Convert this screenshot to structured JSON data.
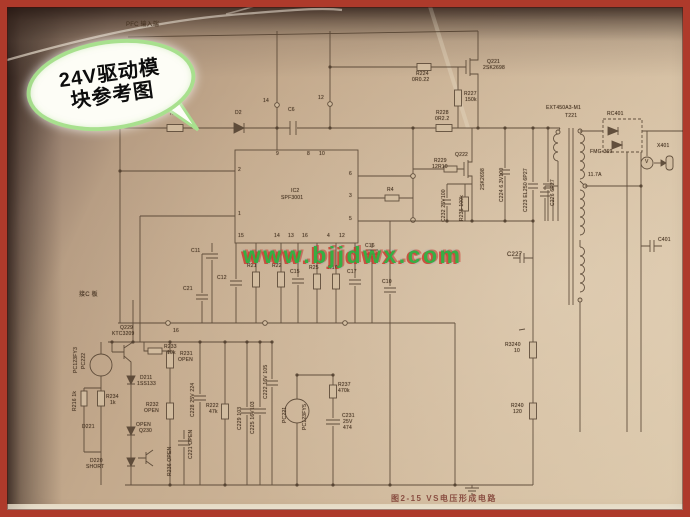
{
  "meta": {
    "figure_caption": "图2-15  VS电压形成电路"
  },
  "callout": {
    "line1": "24V驱动模",
    "line2": "块参考图"
  },
  "watermark": {
    "text": "www.bjjdwx.com"
  },
  "ic": {
    "ref": "IC2",
    "part": "SPF3001"
  },
  "colors": {
    "border": "#ae3a2b",
    "paper": "#ccb497",
    "ink": "#52402f",
    "watermark_green": "#2fae3f",
    "watermark_red": "#cd3728",
    "callout_border": "#a8e08e",
    "caption": "#7d3b31"
  },
  "labels": [
    {
      "t": "PFC 输入端",
      "x": 126,
      "y": 22,
      "s": 6
    },
    {
      "t": "PKG1",
      "x": 80,
      "y": 122,
      "s": 6
    },
    {
      "t": "R1",
      "x": 170,
      "y": 112
    },
    {
      "t": "D2",
      "x": 235,
      "y": 111
    },
    {
      "t": "C6",
      "x": 288,
      "y": 108
    },
    {
      "t": "14",
      "x": 263,
      "y": 99
    },
    {
      "t": "12",
      "x": 318,
      "y": 96
    },
    {
      "t": "R224",
      "x": 416,
      "y": 72
    },
    {
      "t": "0R0.22",
      "x": 412,
      "y": 78
    },
    {
      "t": "Q221",
      "x": 487,
      "y": 60
    },
    {
      "t": "2SK2698",
      "x": 483,
      "y": 66
    },
    {
      "t": "R227",
      "x": 464,
      "y": 92
    },
    {
      "t": "150k",
      "x": 465,
      "y": 98
    },
    {
      "t": "R228",
      "x": 436,
      "y": 111
    },
    {
      "t": "0R2.2",
      "x": 435,
      "y": 117
    },
    {
      "t": "R229",
      "x": 434,
      "y": 159
    },
    {
      "t": "12R10",
      "x": 432,
      "y": 165
    },
    {
      "t": "Q222",
      "x": 455,
      "y": 153
    },
    {
      "t": "2SK2698",
      "x": 481,
      "y": 190,
      "v": 1
    },
    {
      "t": "C232 25V100",
      "x": 442,
      "y": 222,
      "v": 1
    },
    {
      "t": "R235 100k",
      "x": 460,
      "y": 221,
      "v": 1
    },
    {
      "t": "C224 6.3V100",
      "x": 500,
      "y": 202,
      "v": 1
    },
    {
      "t": "C223 EL250 6P27",
      "x": 524,
      "y": 212,
      "v": 1
    },
    {
      "t": "C226 6P27",
      "x": 551,
      "y": 206,
      "v": 1
    },
    {
      "t": "C227",
      "x": 507,
      "y": 252,
      "s": 6
    },
    {
      "t": "EXT450A3-M1",
      "x": 546,
      "y": 106
    },
    {
      "t": "T221",
      "x": 565,
      "y": 114
    },
    {
      "t": "11.7A",
      "x": 588,
      "y": 173
    },
    {
      "t": "RC401",
      "x": 607,
      "y": 112
    },
    {
      "t": "FMG-369",
      "x": 590,
      "y": 150
    },
    {
      "t": "X401",
      "x": 657,
      "y": 144
    },
    {
      "t": "V",
      "x": 645,
      "y": 160
    },
    {
      "t": "C401",
      "x": 658,
      "y": 238
    },
    {
      "t": "R3240",
      "x": 505,
      "y": 343
    },
    {
      "t": "10",
      "x": 514,
      "y": 349
    },
    {
      "t": "R240",
      "x": 511,
      "y": 404
    },
    {
      "t": "120",
      "x": 513,
      "y": 410
    },
    {
      "t": "IC2",
      "x": 291,
      "y": 189
    },
    {
      "t": "SPF3001",
      "x": 281,
      "y": 196
    },
    {
      "t": "9",
      "x": 276,
      "y": 152
    },
    {
      "t": "8",
      "x": 307,
      "y": 152
    },
    {
      "t": "10",
      "x": 319,
      "y": 152
    },
    {
      "t": "2",
      "x": 238,
      "y": 168
    },
    {
      "t": "1",
      "x": 238,
      "y": 212
    },
    {
      "t": "6",
      "x": 349,
      "y": 172
    },
    {
      "t": "3",
      "x": 349,
      "y": 194
    },
    {
      "t": "5",
      "x": 349,
      "y": 217
    },
    {
      "t": "15",
      "x": 238,
      "y": 234
    },
    {
      "t": "14",
      "x": 274,
      "y": 234
    },
    {
      "t": "13",
      "x": 288,
      "y": 234
    },
    {
      "t": "16",
      "x": 302,
      "y": 234
    },
    {
      "t": "4",
      "x": 327,
      "y": 234
    },
    {
      "t": "12",
      "x": 339,
      "y": 234
    },
    {
      "t": "R4",
      "x": 387,
      "y": 188
    },
    {
      "t": "C16",
      "x": 365,
      "y": 244
    },
    {
      "t": "C11",
      "x": 191,
      "y": 249
    },
    {
      "t": "C12",
      "x": 217,
      "y": 276
    },
    {
      "t": "C21",
      "x": 183,
      "y": 287
    },
    {
      "t": "R21",
      "x": 247,
      "y": 264
    },
    {
      "t": "R22",
      "x": 272,
      "y": 264
    },
    {
      "t": "C15",
      "x": 290,
      "y": 270
    },
    {
      "t": "R25",
      "x": 309,
      "y": 266
    },
    {
      "t": "R10",
      "x": 328,
      "y": 266
    },
    {
      "t": "C17",
      "x": 347,
      "y": 270
    },
    {
      "t": "C10",
      "x": 382,
      "y": 280
    },
    {
      "t": "16",
      "x": 173,
      "y": 329
    },
    {
      "t": "接C 板",
      "x": 79,
      "y": 292,
      "s": 6
    },
    {
      "t": "PC123FY3",
      "x": 74,
      "y": 373,
      "v": 1
    },
    {
      "t": "PC222",
      "x": 82,
      "y": 369,
      "v": 1
    },
    {
      "t": "Q229",
      "x": 120,
      "y": 326
    },
    {
      "t": "KTC3209",
      "x": 112,
      "y": 332
    },
    {
      "t": "R233",
      "x": 164,
      "y": 345
    },
    {
      "t": "10k",
      "x": 167,
      "y": 351
    },
    {
      "t": "R231",
      "x": 180,
      "y": 352
    },
    {
      "t": "OPEN",
      "x": 178,
      "y": 358
    },
    {
      "t": "D211",
      "x": 140,
      "y": 376
    },
    {
      "t": "1SS133",
      "x": 137,
      "y": 382
    },
    {
      "t": "R216 1k",
      "x": 73,
      "y": 411,
      "v": 1
    },
    {
      "t": "R234",
      "x": 106,
      "y": 395
    },
    {
      "t": "1k",
      "x": 110,
      "y": 401
    },
    {
      "t": "R232",
      "x": 146,
      "y": 403
    },
    {
      "t": "OPEN",
      "x": 144,
      "y": 409
    },
    {
      "t": "D221",
      "x": 82,
      "y": 425
    },
    {
      "t": "OPEN",
      "x": 136,
      "y": 423
    },
    {
      "t": "Q230",
      "x": 139,
      "y": 429
    },
    {
      "t": "D220",
      "x": 90,
      "y": 459
    },
    {
      "t": "SHORT",
      "x": 86,
      "y": 465
    },
    {
      "t": "R236 OPEN",
      "x": 168,
      "y": 476,
      "v": 1
    },
    {
      "t": "C228 25V 224",
      "x": 191,
      "y": 417,
      "v": 1
    },
    {
      "t": "C221 OPEN",
      "x": 189,
      "y": 459,
      "v": 1
    },
    {
      "t": "R222",
      "x": 206,
      "y": 404
    },
    {
      "t": "47k",
      "x": 209,
      "y": 410
    },
    {
      "t": "C229 103",
      "x": 238,
      "y": 430,
      "v": 1
    },
    {
      "t": "C225 16V103",
      "x": 251,
      "y": 434,
      "v": 1
    },
    {
      "t": "C222 16V 105",
      "x": 264,
      "y": 399,
      "v": 1
    },
    {
      "t": "PC221",
      "x": 283,
      "y": 423,
      "v": 1
    },
    {
      "t": "PC123FY5",
      "x": 303,
      "y": 430,
      "v": 1
    },
    {
      "t": "R237",
      "x": 338,
      "y": 383
    },
    {
      "t": "470k",
      "x": 338,
      "y": 389
    },
    {
      "t": "C231",
      "x": 342,
      "y": 414
    },
    {
      "t": "25V",
      "x": 343,
      "y": 420
    },
    {
      "t": "474",
      "x": 343,
      "y": 426
    }
  ]
}
